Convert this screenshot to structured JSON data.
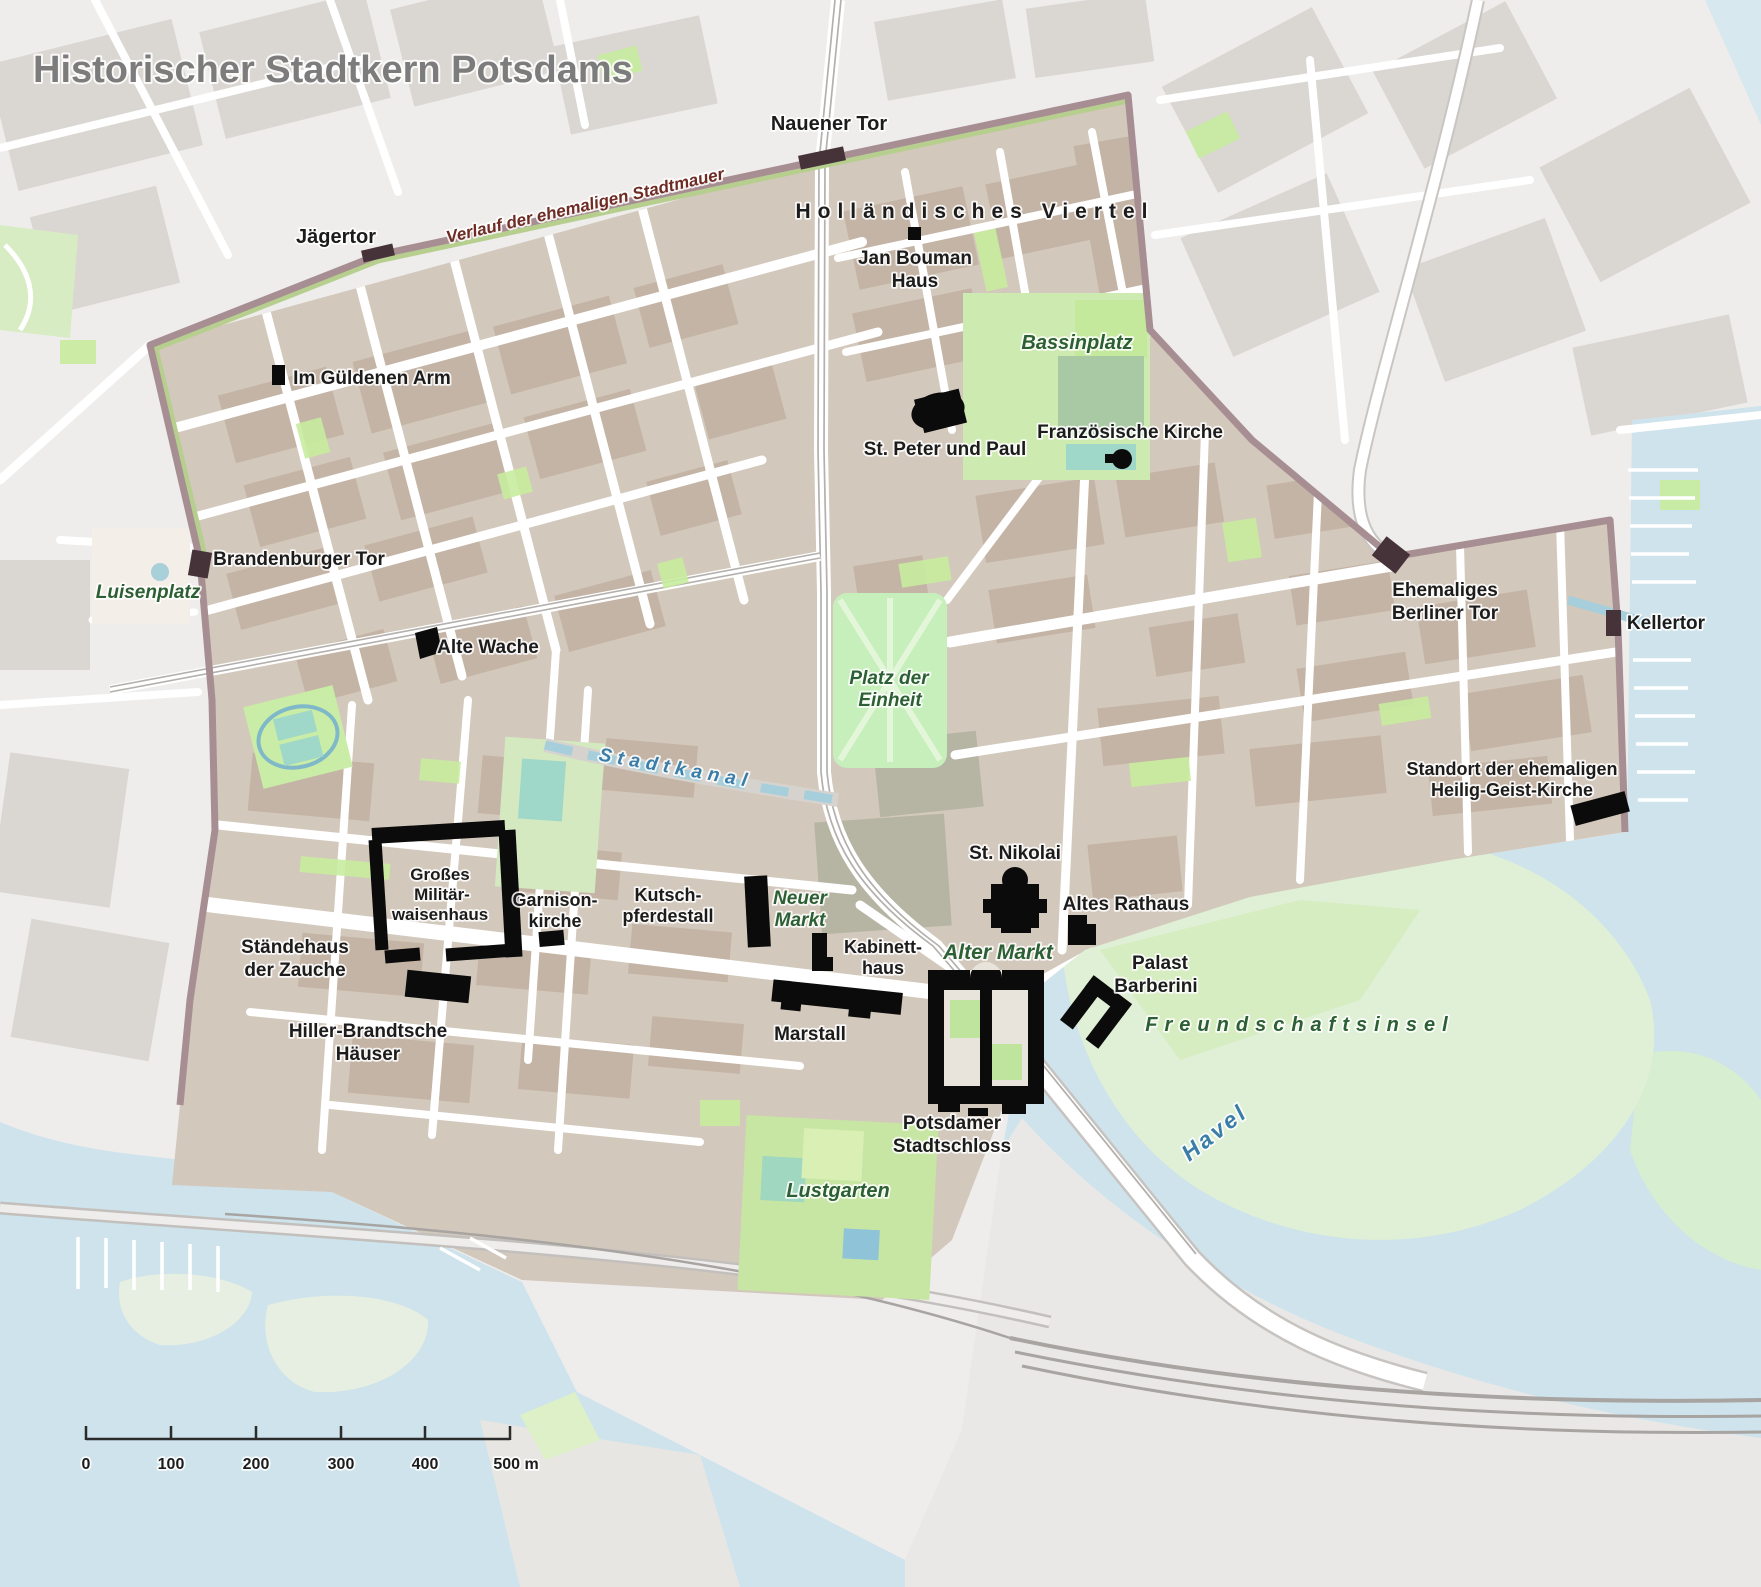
{
  "title": "Historischer Stadtkern Potsdams",
  "wall": {
    "label": "Verlauf der ehemaligen Stadtmauer"
  },
  "scale_bar": {
    "ticks": [
      "0",
      "100",
      "200",
      "300",
      "400",
      "500 m"
    ]
  },
  "colors": {
    "water": "#cee3eb",
    "land_outside": "#eeedec",
    "blocks_outside": "#dad6d2",
    "core_fill": "#d3c8bc",
    "buildings_core": "#c4b4a5",
    "park_green": "#cdeab0",
    "bright_green": "#c6efbc",
    "island_green": "#dff0d6",
    "wall_line": "#a78e92",
    "wall_gate": "#463339",
    "canal_blue": "#a6cfdb",
    "landmark_black": "#0b0b0b",
    "label_black": "#1c1c1c",
    "label_green": "#2c5f33",
    "label_blue": "#3a7da8",
    "label_maroon": "#6e2b23",
    "title_gray": "#7c7c7c"
  },
  "labels": {
    "nauener_tor": "Nauener Tor",
    "jaegertor": "Jägertor",
    "hollaendisches_viertel": "Holländisches Viertel",
    "jan_bouman_1": "Jan Bouman",
    "jan_bouman_2": "Haus",
    "im_gueldenen_arm": "Im Güldenen Arm",
    "bassinplatz": "Bassinplatz",
    "st_peter_und_paul": "St. Peter und Paul",
    "franzoesische_kirche": "Französische Kirche",
    "brandenburger_tor": "Brandenburger Tor",
    "luisenplatz": "Luisenplatz",
    "alte_wache": "Alte Wache",
    "platz_der_einheit_1": "Platz der",
    "platz_der_einheit_2": "Einheit",
    "stadtkanal": "Stadtkanal",
    "berliner_tor_1": "Ehemaliges",
    "berliner_tor_2": "Berliner Tor",
    "kellertor": "Kellertor",
    "heilig_geist_1": "Standort der ehemaligen",
    "heilig_geist_2": "Heilig-Geist-Kirche",
    "waisenhaus_1": "Großes",
    "waisenhaus_2": "Militär-",
    "waisenhaus_3": "waisenhaus",
    "garnisonkirche_1": "Garnison-",
    "garnisonkirche_2": "kirche",
    "kutschpferdestall_1": "Kutsch-",
    "kutschpferdestall_2": "pferdestall",
    "neuer_markt_1": "Neuer",
    "neuer_markt_2": "Markt",
    "kabinetthaus_1": "Kabinett-",
    "kabinetthaus_2": "haus",
    "st_nikolai": "St. Nikolai",
    "altes_rathaus": "Altes Rathaus",
    "alter_markt": "Alter Markt",
    "palast_barberini_1": "Palast",
    "palast_barberini_2": "Barberini",
    "staendehaus_1": "Ständehaus",
    "staendehaus_2": "der Zauche",
    "hiller_1": "Hiller-Brandtsche",
    "hiller_2": "Häuser",
    "marstall": "Marstall",
    "stadtschloss_1": "Potsdamer",
    "stadtschloss_2": "Stadtschloss",
    "freundschaftsinsel": "Freundschaftsinsel",
    "havel": "Havel",
    "lustgarten": "Lustgarten"
  }
}
